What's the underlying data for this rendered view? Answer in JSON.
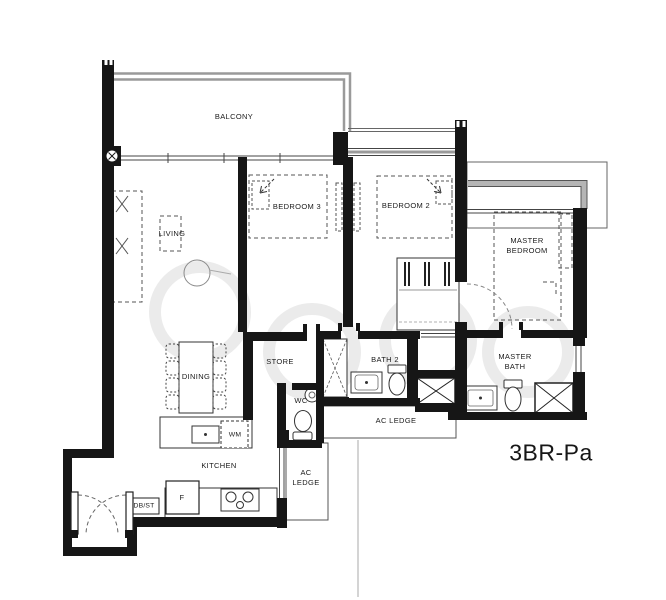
{
  "plan": {
    "code": "3BR-Pa",
    "colors": {
      "walls": "#161616",
      "window_gray": "#9a9a9a",
      "watermark": "#dedede",
      "background": "#ffffff"
    }
  },
  "rooms": {
    "balcony": {
      "label": "BALCONY"
    },
    "living": {
      "label": "LIVING"
    },
    "dining": {
      "label": "DINING"
    },
    "kitchen": {
      "label": "KITCHEN"
    },
    "bedroom3": {
      "label": "BEDROOM 3"
    },
    "bedroom2": {
      "label": "BEDROOM 2"
    },
    "master_bedroom": {
      "label": "MASTER\nBEDROOM"
    },
    "store": {
      "label": "STORE"
    },
    "wc": {
      "label": "WC"
    },
    "bath2": {
      "label": "BATH 2"
    },
    "master_bath": {
      "label": "MASTER\nBATH"
    },
    "ac_ledge_mid": {
      "label": "AC LEDGE"
    },
    "ac_ledge_kitchen": {
      "label": "AC\nLEDGE"
    }
  },
  "fixtures": {
    "washing_machine": {
      "label": "WM"
    },
    "fridge": {
      "label": "F"
    },
    "db_st": {
      "label": "DB/ST"
    }
  }
}
